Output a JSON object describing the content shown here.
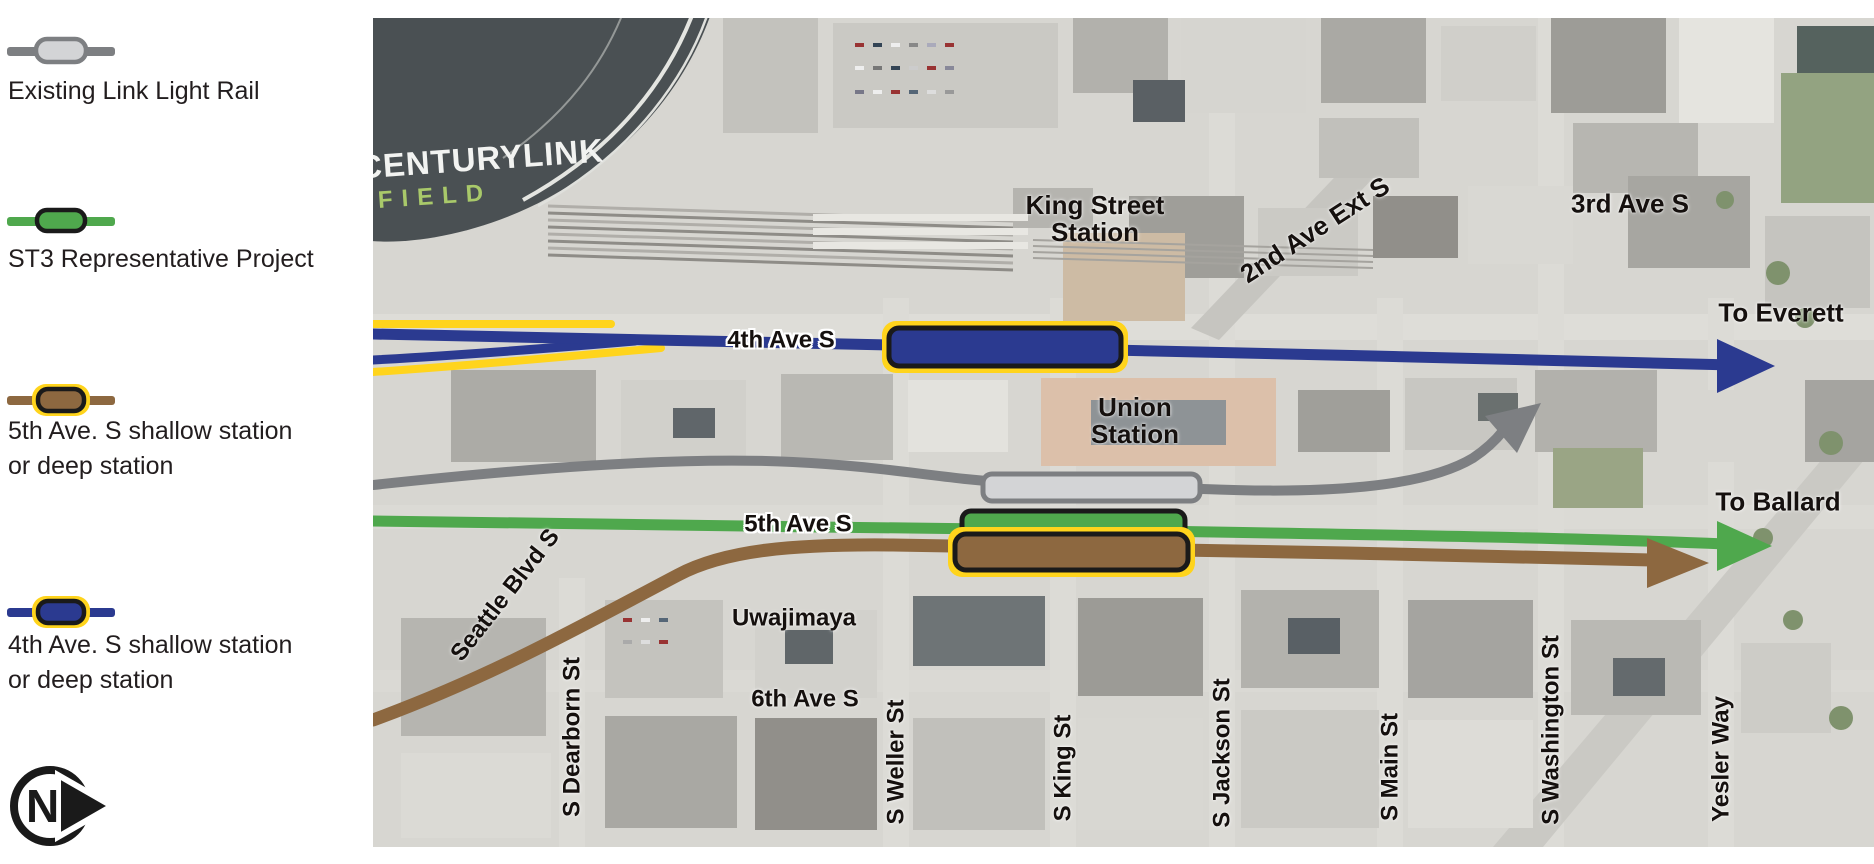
{
  "legend": {
    "items": [
      {
        "line1": "Existing Link Light Rail",
        "line2": "",
        "line_color": "#7d7f82",
        "box_fill": "#d3d4d6",
        "box_stroke": "#7d7f82",
        "ring_color": ""
      },
      {
        "line1": "ST3 Representative Project",
        "line2": "",
        "line_color": "#4fa84d",
        "box_fill": "#4fa84d",
        "box_stroke": "#1a1a1a",
        "ring_color": ""
      },
      {
        "line1": "5th Ave. S shallow station",
        "line2": "or deep station",
        "line_color": "#8d6840",
        "box_fill": "#8d6840",
        "box_stroke": "#1a1a1a",
        "ring_color": "#ffd41c"
      },
      {
        "line1": "4th Ave. S shallow station",
        "line2": "or deep station",
        "line_color": "#2b3a90",
        "box_fill": "#2b3a90",
        "box_stroke": "#1a1a1a",
        "ring_color": "#ffd41c"
      }
    ],
    "north_label": "N"
  },
  "map": {
    "colors": {
      "blue": "#2b3a90",
      "yellow": "#ffd41c",
      "green": "#4fa84d",
      "brown": "#8d6840",
      "gray": "#7d7f82",
      "gray_fill": "#d3d4d6",
      "black": "#1a1a1a"
    },
    "stadium": {
      "name": "CENTURYLINK",
      "field": "FIELD"
    },
    "labels": {
      "king_street_1": "King Street",
      "king_street_2": "Station",
      "second_ave": "2nd Ave Ext S",
      "third_ave": "3rd Ave S",
      "to_everett": "To Everett",
      "fourth_ave": "4th Ave S",
      "union_1": "Union",
      "union_2": "Station",
      "to_ballard": "To Ballard",
      "fifth_ave": "5th Ave S",
      "seattle_blvd": "Seattle Blvd S",
      "uwajimaya": "Uwajimaya",
      "sixth_ave": "6th Ave S",
      "dearborn": "S Dearborn St",
      "weller": "S Weller St",
      "king": "S King St",
      "jackson": "S Jackson St",
      "main": "S Main St",
      "washington": "S Washington St",
      "yesler": "Yesler Way"
    }
  }
}
